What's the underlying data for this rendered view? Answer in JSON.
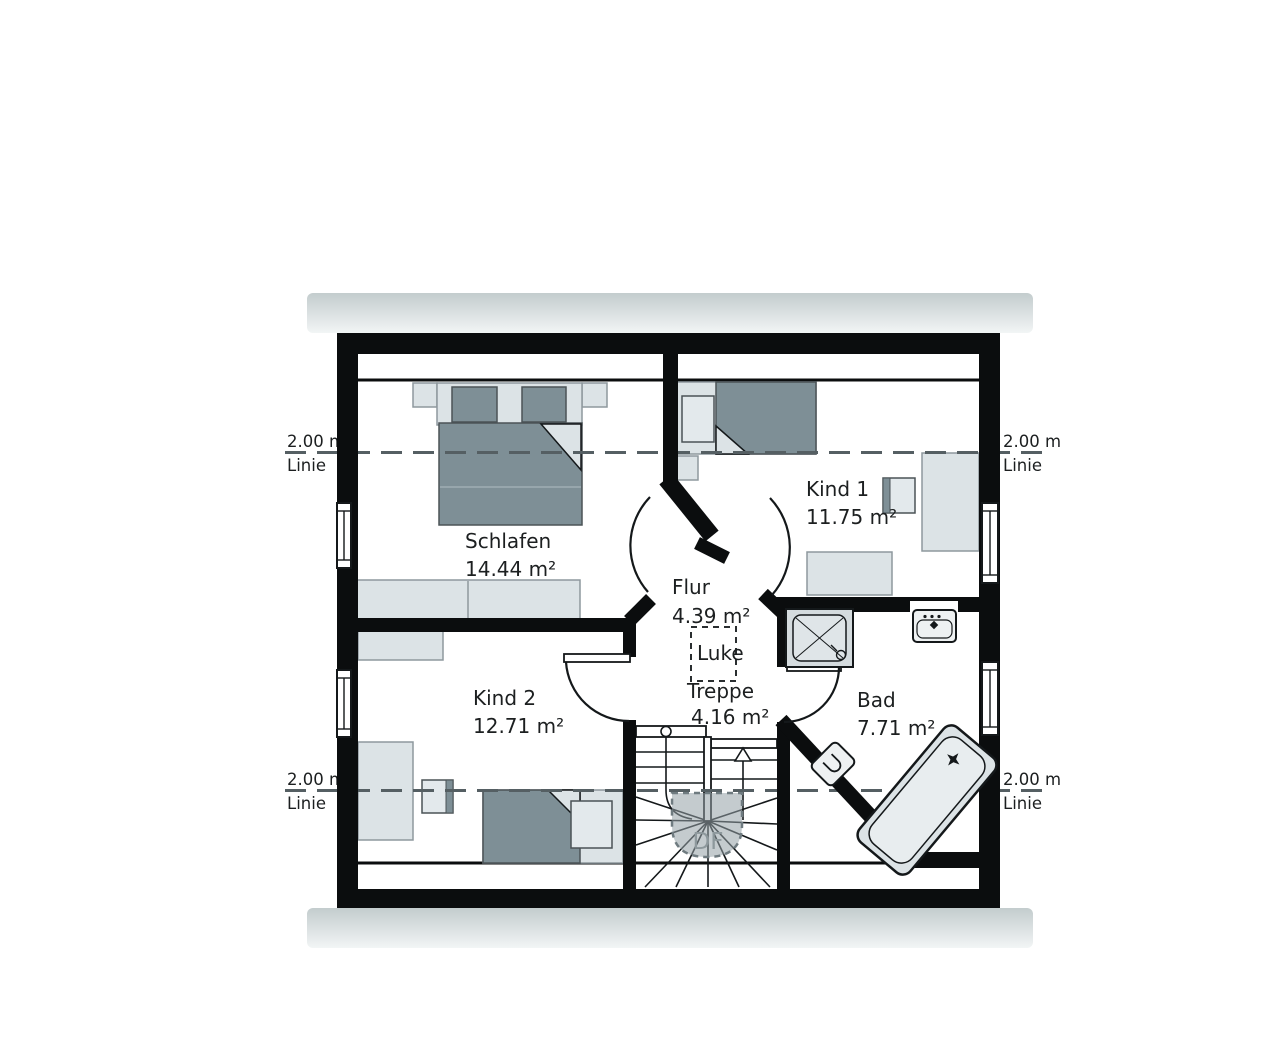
{
  "labels": {
    "rooms": [
      {
        "name": "Schlafen",
        "area": "14.44 m²"
      },
      {
        "name": "Kind 1",
        "area": "11.75 m²"
      },
      {
        "name": "Kind 2",
        "area": "12.71 m²"
      },
      {
        "name": "Flur",
        "area": "4.39 m²"
      },
      {
        "name": "Treppe",
        "area": "4.16 m²"
      },
      {
        "name": "Bad",
        "area": "7.71 m²"
      }
    ],
    "hatch": "Luke",
    "roof_window": "DF",
    "height_line": {
      "value": "2.00 m",
      "label": "Linie"
    }
  },
  "colors": {
    "wall": "#0b0d0e",
    "furniture_light": "#dce3e6",
    "furniture_dark": "#7e8f96",
    "furniture_stroke": "#8e989d",
    "eave_top": "#c3cccd",
    "eave_bottom": "#f2f5f5",
    "dash_line": "#555f63",
    "text": "#1c1f20",
    "df_text": "#8d989c",
    "fixture_fill": "#eef1f2"
  }
}
